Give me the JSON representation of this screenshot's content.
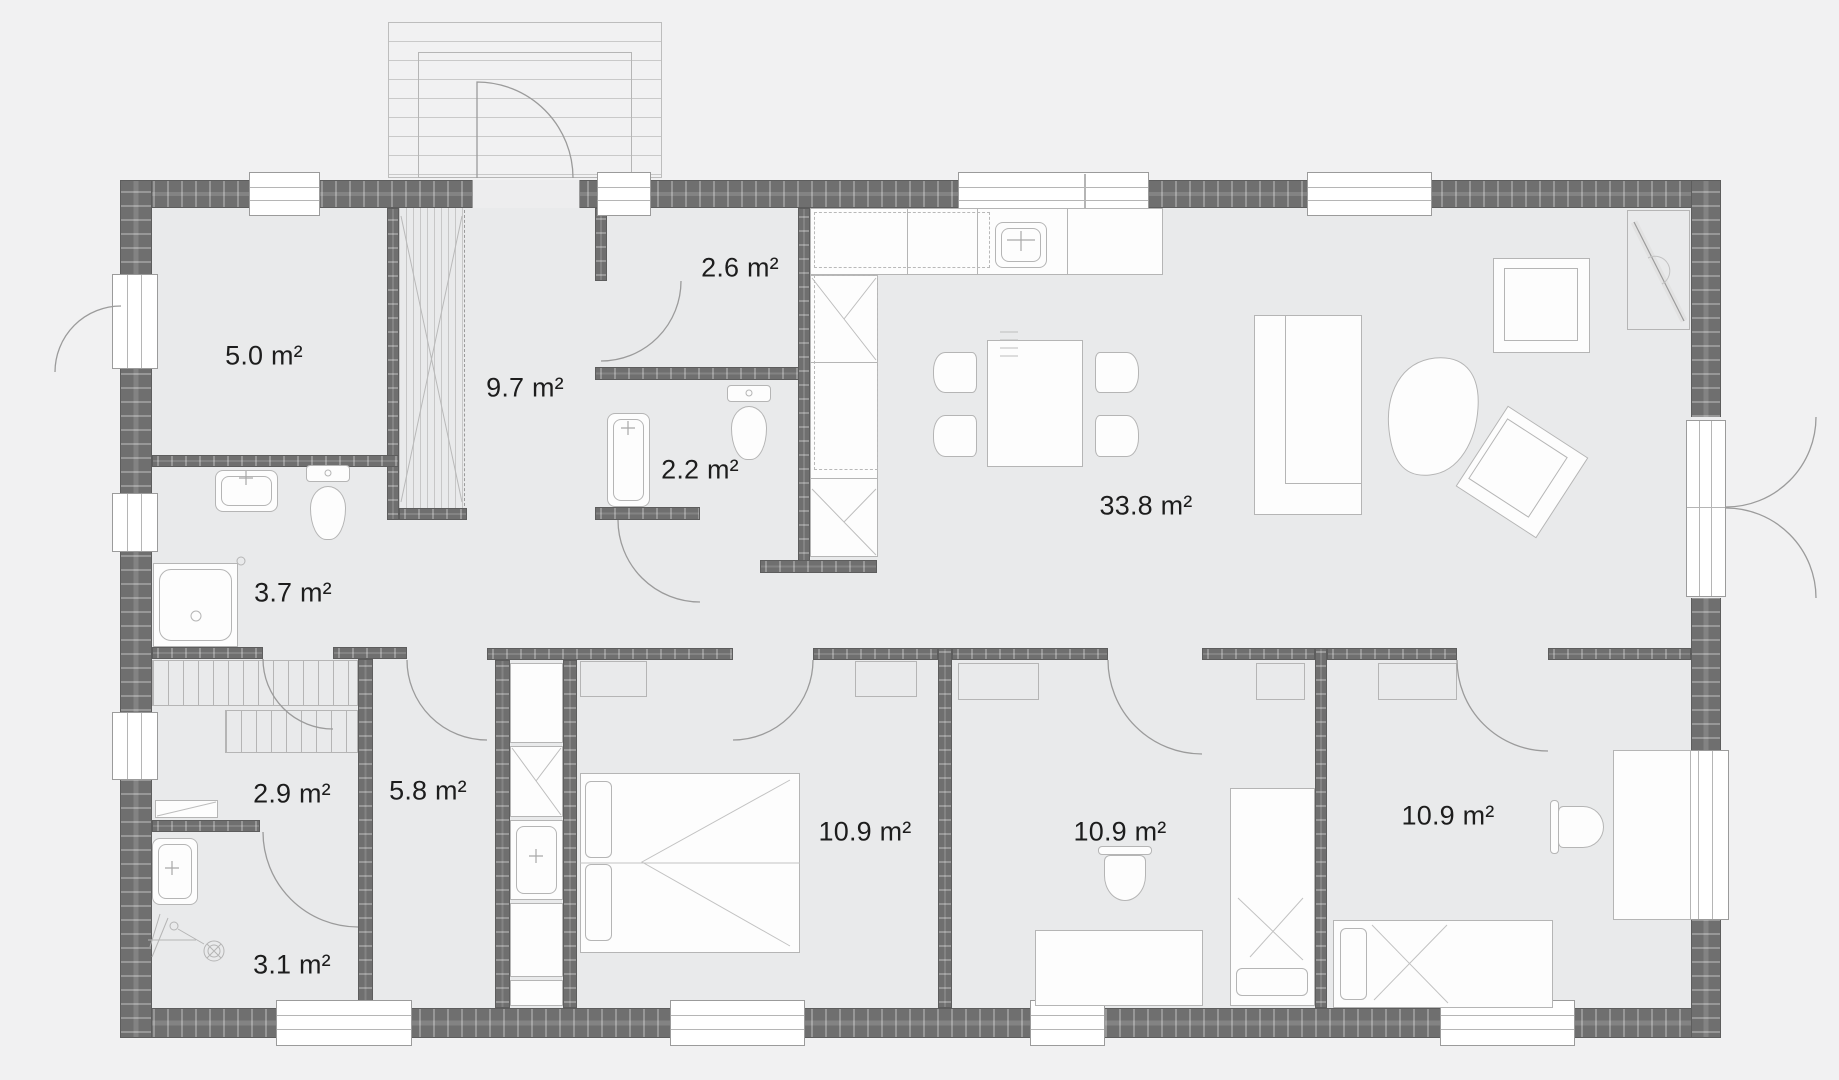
{
  "figure": "single-storey house floor plan",
  "colors": {
    "bg": "#f1f1f2",
    "floor": "#e9eaeb",
    "wall": "#6f6f6f",
    "wall-edge": "#5d5d5d",
    "line": "#b5b5b5",
    "frame": "#9b9b9b",
    "furn": "#fdfdfd",
    "ink": "#1d1d1d"
  },
  "rooms": [
    {
      "name": "storage-room",
      "area": "5.0 m²"
    },
    {
      "name": "hall",
      "area": "9.7 m²"
    },
    {
      "name": "wc",
      "area": "2.6 m²"
    },
    {
      "name": "bathroom-small",
      "area": "2.2 m²"
    },
    {
      "name": "living-kitchen",
      "area": "33.8 m²"
    },
    {
      "name": "bathroom",
      "area": "3.7 m²"
    },
    {
      "name": "landing",
      "area": "2.9 m²"
    },
    {
      "name": "hallway",
      "area": "5.8 m²"
    },
    {
      "name": "shower-room",
      "area": "3.1 m²"
    },
    {
      "name": "bedroom-left",
      "area": "10.9 m²"
    },
    {
      "name": "bedroom-middle",
      "area": "10.9 m²"
    },
    {
      "name": "bedroom-right",
      "area": "10.9 m²"
    }
  ]
}
